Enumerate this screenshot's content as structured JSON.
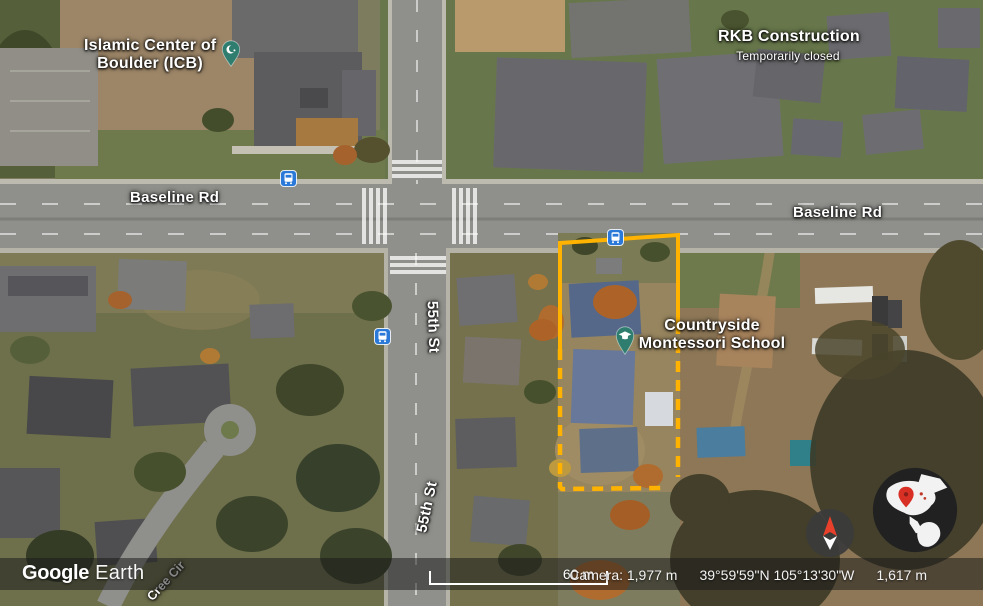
{
  "labels": {
    "islamic_center_line1": "Islamic Center of",
    "islamic_center_line2": "Boulder (ICB)",
    "rkb_name": "RKB Construction",
    "rkb_status": "Temporarily closed",
    "baseline_rd_west": "Baseline Rd",
    "baseline_rd_east": "Baseline Rd",
    "street_55th_north": "55th St",
    "street_55th_south": "55th St",
    "cree_cir": "Cree Cir",
    "school_line1": "Countryside",
    "school_line2": "Montessori School"
  },
  "status_bar": {
    "logo_google": "Google",
    "logo_earth": "Earth",
    "scale_label": "60 m",
    "camera": "Camera: 1,977 m",
    "coordinates": "39°59'59\"N 105°13'30\"W",
    "elevation": "1,617 m"
  },
  "icons": {
    "bus_stop_count": 3,
    "islamic_center_pin": "crescent-and-star",
    "school_pin": "graduation-cap",
    "compass": "north-arrow",
    "globe": "earth-overview-with-red-pin"
  },
  "colors": {
    "property_boundary": "#FFB300",
    "place_pin_teal": "#2E7D6E",
    "bus_icon_blue": "#2A79D8",
    "globe_pin_red": "#D93025"
  }
}
